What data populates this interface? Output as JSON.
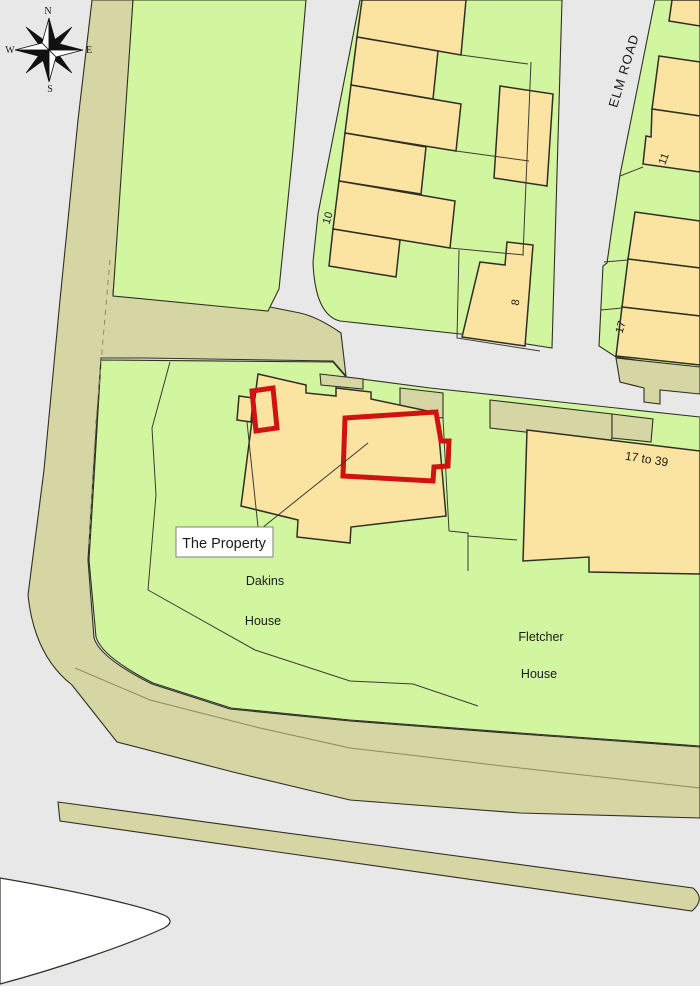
{
  "colors": {
    "road_grey": "#e8e8e8",
    "parcel_green": "#d2f5a0",
    "verge_olive": "#d6d6a4",
    "building_tan": "#fbe3a1",
    "outline_dark": "#2f2f23",
    "line_thin": "#3c3c30",
    "line_soft": "#8a8a60",
    "red_outline": "#cf1310",
    "white_area": "#ffffff",
    "label_border": "#808080",
    "text_dark": "#1c1c1c",
    "compass_dark": "#111111"
  },
  "labels": {
    "the_property": "The Property",
    "dakins_line1": "Dakins",
    "dakins_line2": "House",
    "fletcher_line1": "Fletcher",
    "fletcher_line2": "House",
    "elm_road": "ELM ROAD",
    "range_17_39": "17 to 39",
    "no_10": "10",
    "no_11": "11",
    "no_8": "8",
    "no_17": "17"
  },
  "compass": {
    "n": "N",
    "e": "E",
    "s": "S",
    "w": "W"
  }
}
